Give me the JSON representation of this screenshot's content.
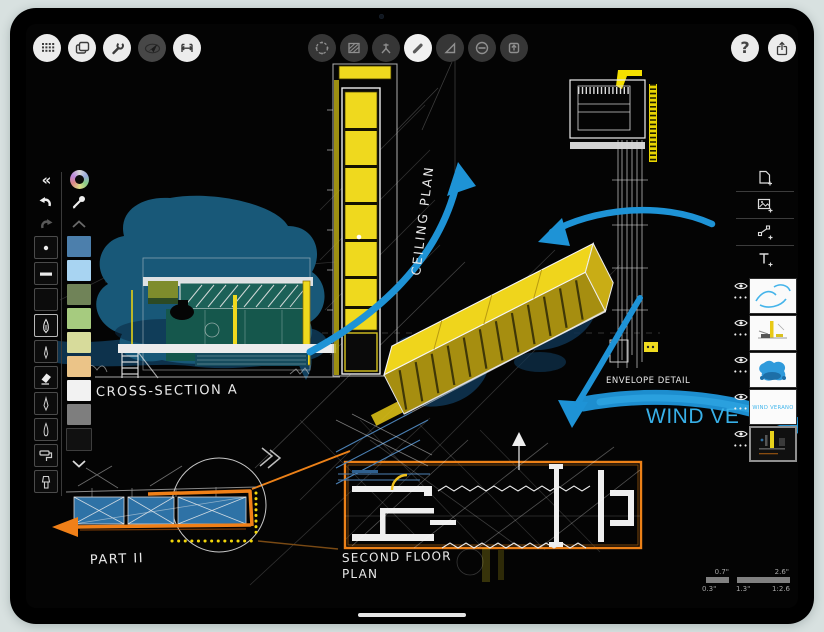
{
  "device": {
    "type": "tablet",
    "orientation": "landscape"
  },
  "colors": {
    "background": "#D8E1E0",
    "canvas_yellow": "#EFD91E",
    "arrow_blue": "#1E93D6",
    "sketch_orange": "#EC8118",
    "wind_text_blue": "#38B0E8",
    "blob_blue": "#185878",
    "teal_fill": "#15574C"
  },
  "toolbar": {
    "help_glyph": "?",
    "left_icons": [
      "grid-dots",
      "pages",
      "wrench",
      "navigate",
      "measure"
    ],
    "center_icons": [
      "selection",
      "fill-hatch",
      "compass",
      "pen",
      "set-square",
      "slice",
      "export-up"
    ],
    "center_active": "pen",
    "right_icons": [
      "help",
      "share"
    ]
  },
  "sidebar": {
    "collapse_glyph": "«",
    "top_icons": [
      "color-wheel",
      "eyedropper",
      "chevron-up"
    ],
    "tools": [
      "dot-pen",
      "flat-line",
      "blank",
      "fountain-pen",
      "fineliner",
      "eraser",
      "pen-outline",
      "brush-pen",
      "paint-roller",
      "marker"
    ],
    "selected_tool": "fountain-pen",
    "swatches": [
      "#4C7FAC",
      "#A8D4F2",
      "#708358",
      "#A6CB7F",
      "#D7DB9B",
      "#EBC488",
      "#F2F2F2",
      "#7E7E7E",
      "#111111"
    ],
    "bottom_icon": "chevron-down"
  },
  "layers": {
    "add_icons": [
      "new-page",
      "add-image",
      "add-shape",
      "add-text"
    ],
    "more_glyph": "•••",
    "items": [
      {
        "name": "blue-arrows-layer",
        "visible": true,
        "selected": false,
        "thumb_text": ""
      },
      {
        "name": "yellow-sketch-layer",
        "visible": true,
        "selected": false,
        "thumb_text": ""
      },
      {
        "name": "blue-mass-layer",
        "visible": true,
        "selected": false,
        "thumb_text": ""
      },
      {
        "name": "wind-verano-layer",
        "visible": true,
        "selected": false,
        "thumb_text": "WIND VERANO"
      },
      {
        "name": "dark-canvas-layer",
        "visible": true,
        "selected": true,
        "thumb_text": ""
      }
    ]
  },
  "canvas": {
    "annotations": {
      "cross_section": "CROSS-SECTION A",
      "ceiling_plan": "CEILING PLAN",
      "envelope_detail": "ENVELOPE DETAIL",
      "wind_text": "WIND VE",
      "second_floor_1": "SECOND FLOOR",
      "second_floor_2": "PLAN",
      "part": "PART II"
    },
    "scale": {
      "t1": "0.7\"",
      "t2": "2.6\"",
      "b1": "0.3\"",
      "b2": "1.3\"",
      "b3": "1:2.6"
    }
  }
}
